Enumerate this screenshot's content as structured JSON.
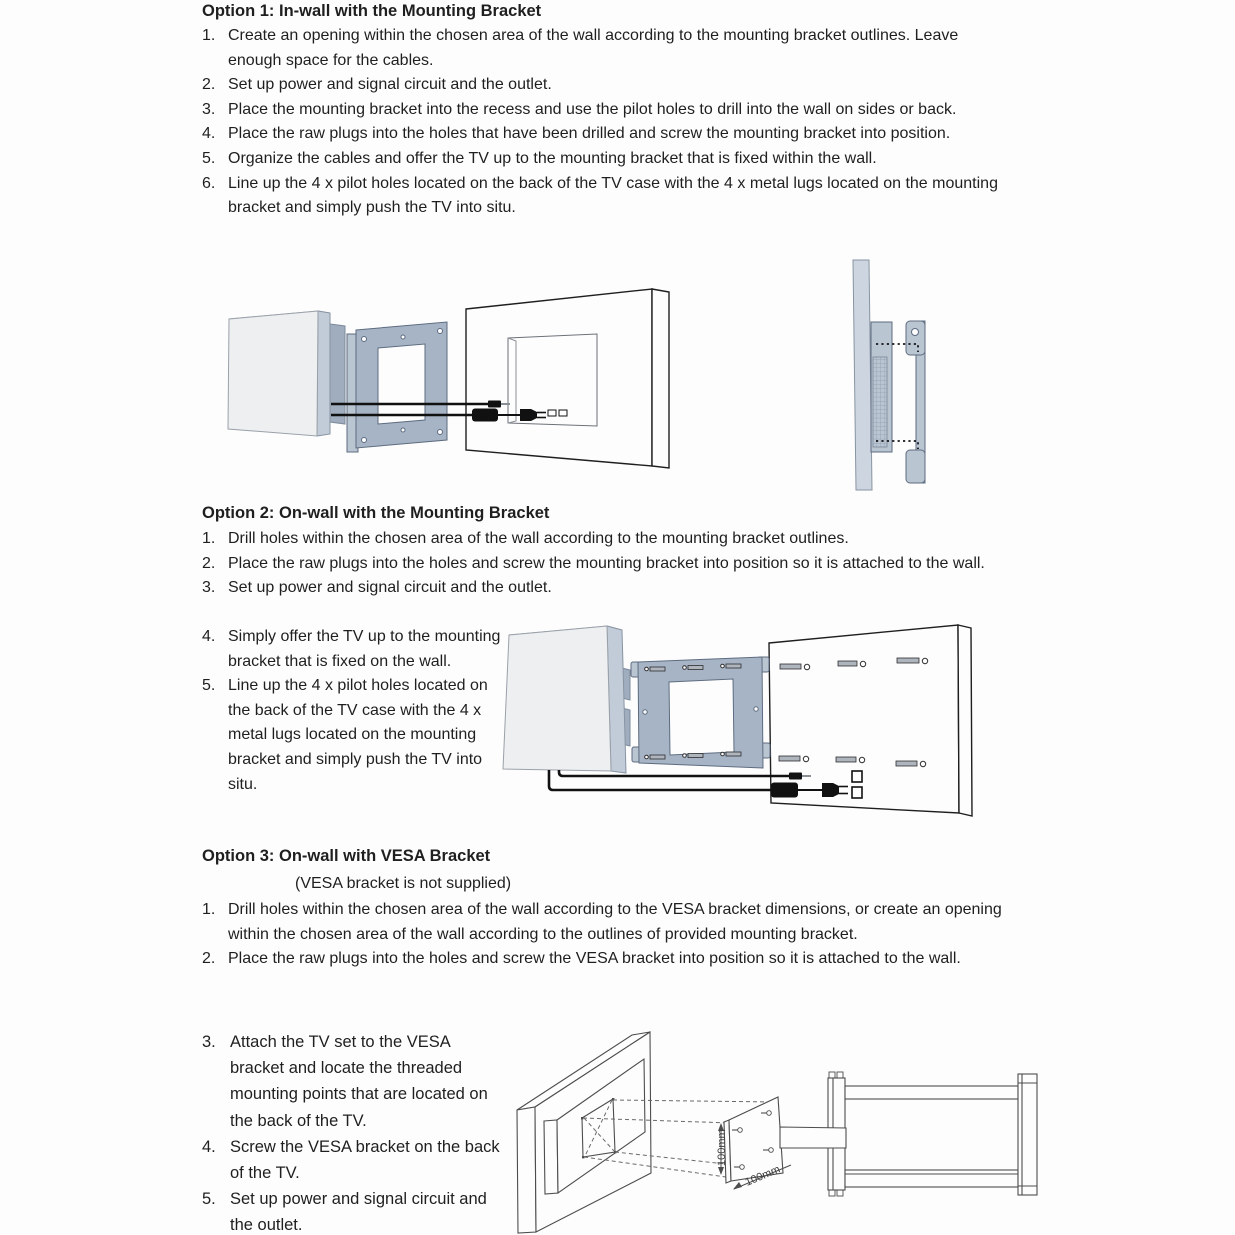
{
  "option1": {
    "title": "Option 1: In-wall with the Mounting Bracket",
    "steps": [
      {
        "num": "1.",
        "text": "Create an opening within the chosen area of the wall according to the mounting bracket outlines. Leave enough space for the cables."
      },
      {
        "num": "2.",
        "text": "Set up power and signal circuit and the outlet."
      },
      {
        "num": "3.",
        "text": "Place the mounting bracket into the recess and use the pilot holes to drill into the wall on sides or back."
      },
      {
        "num": "4.",
        "text": "Place the raw plugs into the holes that have been drilled and screw the mounting bracket into position."
      },
      {
        "num": "5.",
        "text": "Organize the cables and offer the TV up to the mounting bracket that is fixed within the wall."
      },
      {
        "num": "6.",
        "text": "Line up the 4 x pilot holes located on the back of the TV case with the 4 x metal lugs located on the mounting bracket and simply push the TV into situ."
      }
    ]
  },
  "option2": {
    "title": "Option 2: On-wall with the Mounting Bracket",
    "steps_full": [
      {
        "num": "1.",
        "text": "Drill holes within the chosen area of the wall according to the mounting bracket outlines."
      },
      {
        "num": "2.",
        "text": "Place the raw plugs into the holes and screw the mounting bracket into position so it is attached to the wall."
      },
      {
        "num": "3.",
        "text": "Set up power and signal circuit and the outlet."
      }
    ],
    "steps_col": [
      {
        "num": "4.",
        "text": "Simply offer the TV up to the mounting bracket that is fixed on the wall."
      },
      {
        "num": "5.",
        "text": "Line up the 4 x pilot holes located on the back of the TV case with the 4 x metal lugs located on the mounting bracket and simply push the TV into situ."
      }
    ]
  },
  "option3": {
    "title": "Option 3: On-wall with VESA Bracket",
    "note": "(VESA bracket is not supplied)",
    "steps_full": [
      {
        "num": "1.",
        "text": "Drill holes within the chosen area of the wall according to the VESA bracket dimensions, or create an opening within the chosen area of the wall according to the outlines of provided mounting bracket."
      },
      {
        "num": "2.",
        "text": "Place the raw plugs into the holes and screw the VESA bracket into position so it is attached to the wall."
      }
    ],
    "steps_col": [
      {
        "num": "3.",
        "text": "Attach the TV set to the VESA bracket and locate the threaded mounting points that are located on the back of the TV."
      },
      {
        "num": "4.",
        "text": "Screw the VESA bracket on the back of the TV."
      },
      {
        "num": "5.",
        "text": "Set up power and signal circuit and the outlet."
      }
    ]
  },
  "diagram3": {
    "dim_vertical": "100mm",
    "dim_diagonal": "100mm"
  },
  "colors": {
    "paper": "#fdfdfd",
    "ink": "#1f1f1f",
    "bracket": "#a7b4c6",
    "bracket_stroke": "#5d6c80",
    "bracket_light": "#bac5d2",
    "tv_face": "#edeff1",
    "tv_edge": "#c2ccd8",
    "tv_back": "#9fadbf",
    "panel_side": "#ccd5e0",
    "cable": "#111111",
    "drawing": "#4d4d4d"
  }
}
